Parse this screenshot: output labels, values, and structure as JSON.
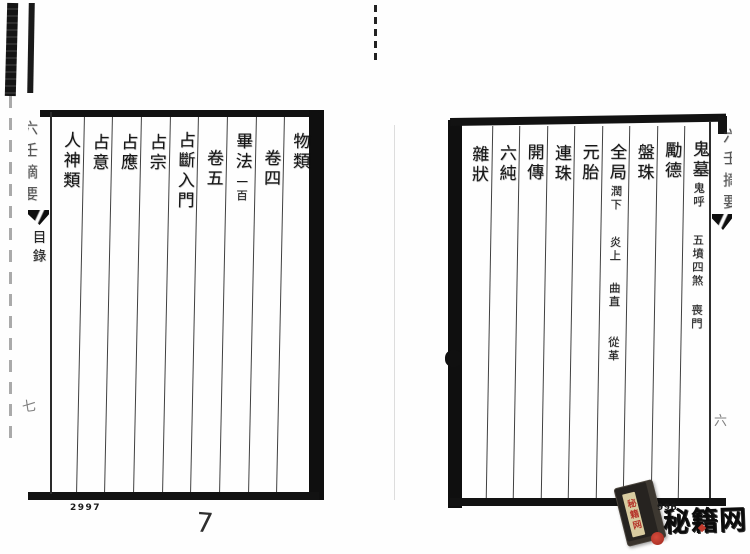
{
  "left_page": {
    "spine": {
      "title_partial": "六壬摘要",
      "section_label": "目錄"
    },
    "columns": [
      {
        "title": "物類"
      },
      {
        "title": "卷四"
      },
      {
        "title": "畢法",
        "subs": [
          "一百"
        ]
      },
      {
        "title": "卷五"
      },
      {
        "title": "占斷入門"
      },
      {
        "title": "占宗"
      },
      {
        "title": "占應"
      },
      {
        "title": "占意"
      },
      {
        "title": "人神類"
      }
    ],
    "leaf_number": "七",
    "page_number": "2997",
    "handwritten_page_number": "7"
  },
  "right_page": {
    "spine": {
      "title_partial": "六壬摘要",
      "leaf_number": "六"
    },
    "columns": [
      {
        "title": "鬼墓",
        "subs": [
          "鬼呼",
          "五墳四煞",
          "喪門"
        ]
      },
      {
        "title": "勵德"
      },
      {
        "title": "盤珠"
      },
      {
        "title": "全局",
        "subs": [
          "潤下",
          "炎上",
          "曲直",
          "從革"
        ]
      },
      {
        "title": "元胎"
      },
      {
        "title": "連珠"
      },
      {
        "title": "開傳"
      },
      {
        "title": "六純"
      },
      {
        "title": "雜狀"
      }
    ],
    "page_number_visible": "996"
  },
  "watermark": {
    "brand": "秘籍网",
    "book_label": "秘籍网",
    "accent_color": "#b5342a",
    "ink_color": "#111111"
  }
}
